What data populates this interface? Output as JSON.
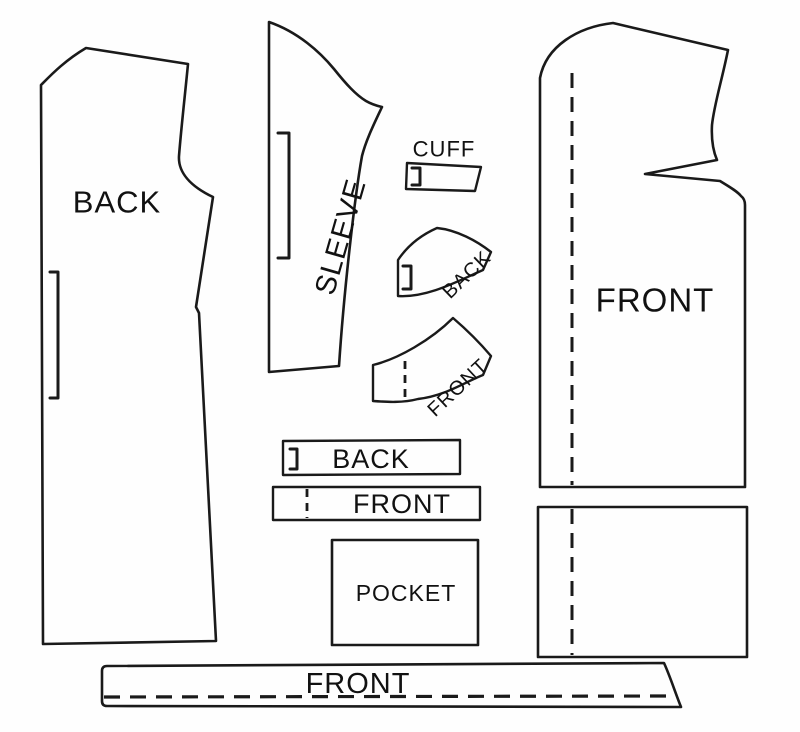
{
  "colors": {
    "line": "#1a1a1a",
    "background": "#fefefe",
    "text": "#111111"
  },
  "pieces": {
    "back_body": {
      "label": "BACK"
    },
    "sleeve": {
      "label": "SLEEVE"
    },
    "cuff": {
      "label": "CUFF"
    },
    "collar_back": {
      "label": "BACK"
    },
    "collar_front": {
      "label": "FRONT"
    },
    "band_back": {
      "label": "BACK"
    },
    "band_front": {
      "label": "FRONT"
    },
    "pocket": {
      "label": "POCKET"
    },
    "front_body": {
      "label": "FRONT"
    },
    "front_facing": {
      "label": "FRONT"
    }
  }
}
